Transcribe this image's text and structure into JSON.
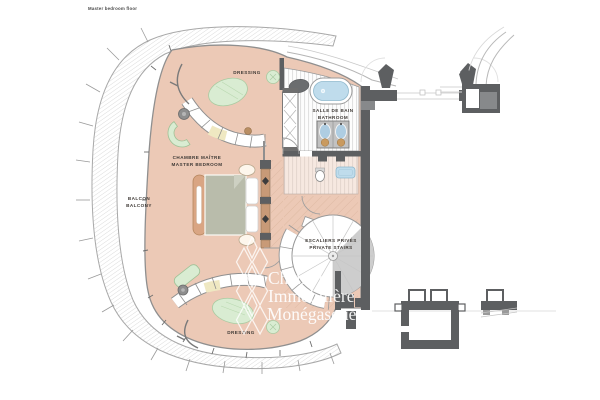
{
  "title": "Master bedroom floor",
  "labels": {
    "balcony_fr": "BALCON",
    "balcony_en": "BALCONY",
    "bedroom_fr": "CHAMBRE MAÎTRE",
    "bedroom_en": "MASTER BEDROOM",
    "dressing_top": "DRESSING",
    "dressing_bottom": "DRESSING",
    "bathroom_fr": "SALLE DE BAIN",
    "bathroom_en": "BATHROOM",
    "stairs_fr": "ESCALIERS PRIVÉS",
    "stairs_en": "PRIVATE STAIRS"
  },
  "watermark": {
    "line1": "Chambre",
    "line2": "Immobilière",
    "line3": "Monégasque"
  },
  "colors": {
    "floor_salmon": "#ecc9b6",
    "rug_green": "#d9ecd2",
    "wall_dark": "#5d5f61",
    "water_blue": "#bfdcec",
    "wood_tan": "#d9a583"
  }
}
